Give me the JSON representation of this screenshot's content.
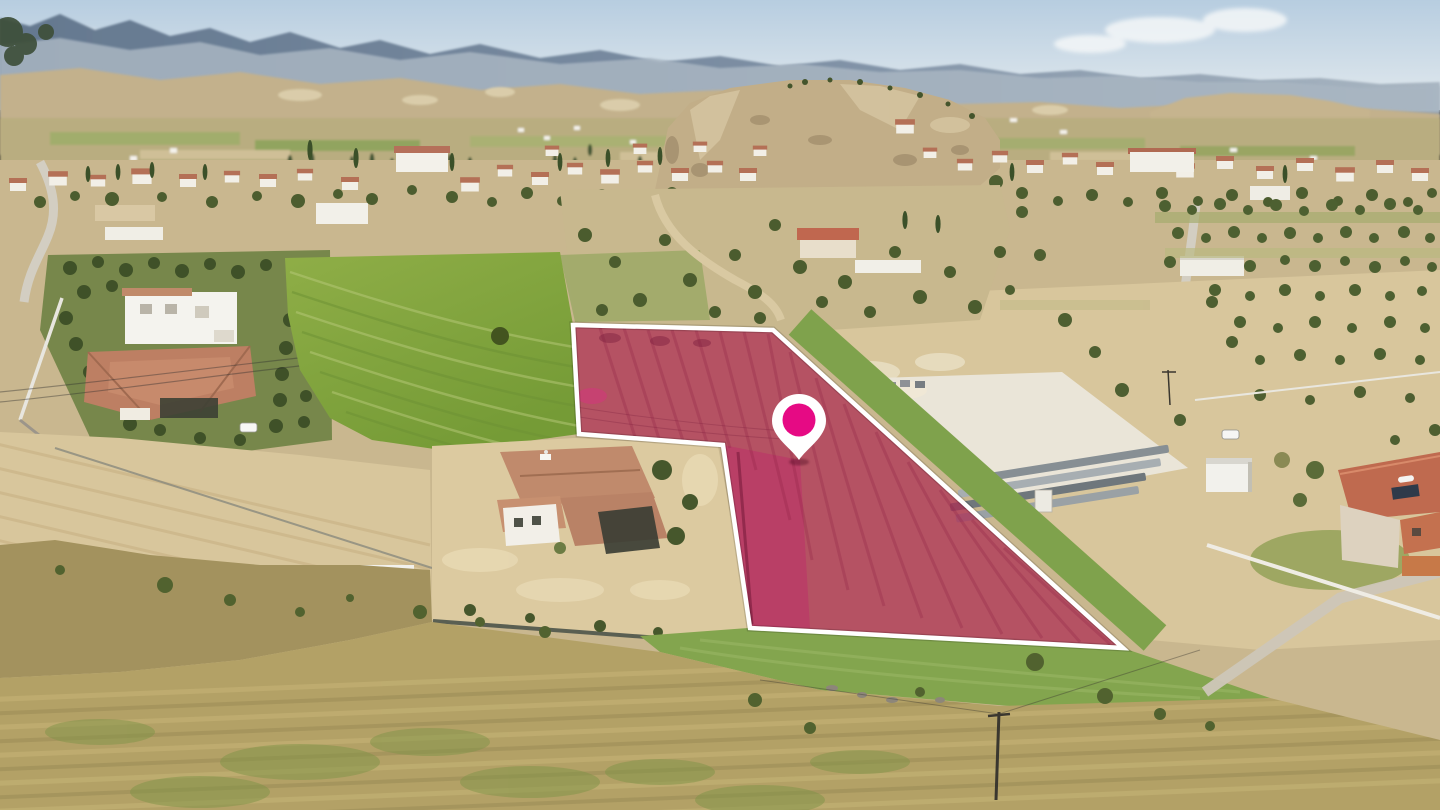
{
  "image": {
    "kind": "aerial-drone-photograph",
    "description": "Aerial drone photo of a Cypriot village landscape: a land parcel highlighted in pink with a white boundary line and a magenta map location pin, surrounded by houses with terracotta roofs, olive groves, green and plowed fields, a storage yard with concrete blocks, and hazy mountains on the horizon."
  },
  "overlay": {
    "parcel": {
      "points": "573,325 773,330 1123,648 750,628 723,445 579,434",
      "fill": "#ad2b52",
      "fill_opacity": "0.72",
      "arm_fill": "#c11d6d",
      "arm_opacity": "0.35",
      "stroke": "#ffffff",
      "stroke_width": "4.5"
    },
    "pin": {
      "transform": "translate(799,424)",
      "body_color": "#ffffff",
      "dot_color": "#e60a84"
    }
  },
  "palette": {
    "sky_top": "#b7cde0",
    "sky_horizon": "#e3eaee",
    "mountains": "#7d8fa4",
    "haze": "#a9b6c2",
    "hills": "#c3b18c",
    "ground": "#c9b78f",
    "soil": "#d8c69c",
    "field_green_light": "#8fae47",
    "field_green_dark": "#759b36",
    "dry_grass": "#b3a166",
    "grass_margin": "#7fa24c",
    "yard_concrete": "#eae5d8",
    "roof_terracotta": "#b47056",
    "wall_white": "#f2efe7"
  }
}
